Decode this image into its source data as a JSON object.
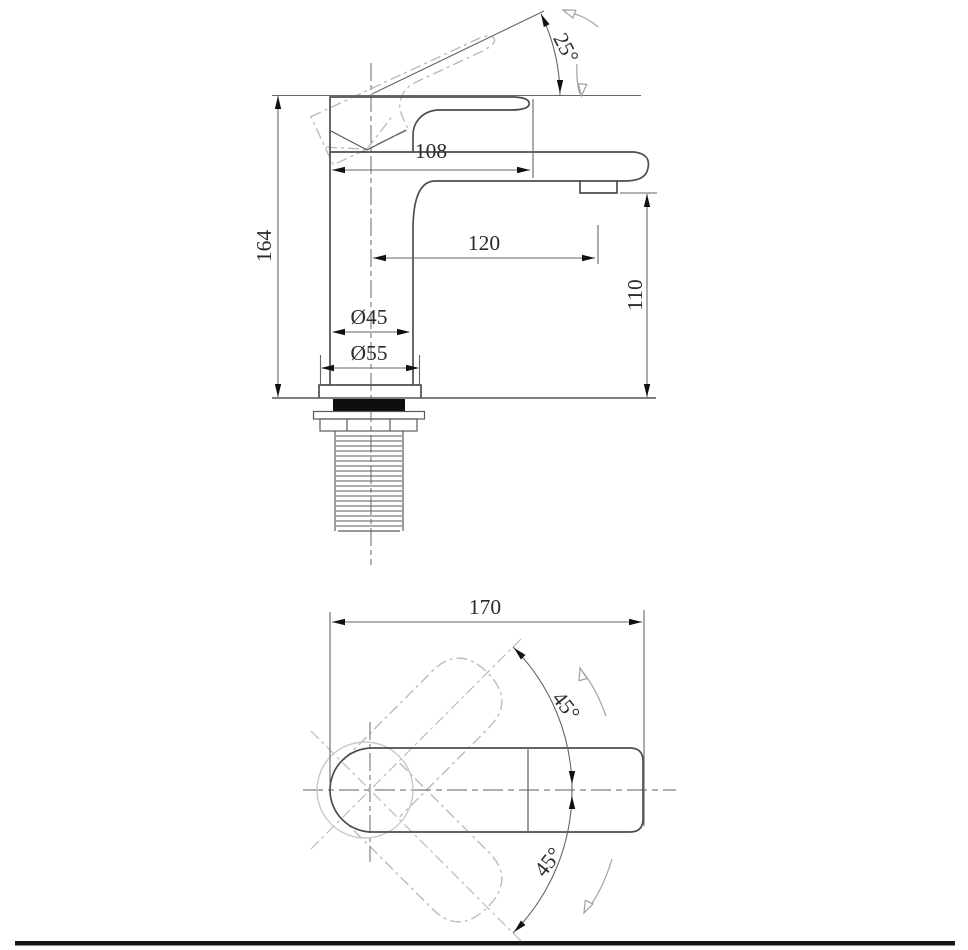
{
  "drawing": {
    "background": "#ffffff",
    "line_color": "#4d4d4d",
    "phantom_color": "#bcbcbc",
    "text_color": "#2b2b2b",
    "side_view": {
      "height": "164",
      "handle_length": "108",
      "spout_reach": "120",
      "spout_height": "110",
      "body_diameter": "Ø45",
      "base_diameter": "Ø55",
      "handle_lift_angle": "25°"
    },
    "top_view": {
      "overall_length": "170",
      "swing_angle_up": "45°",
      "swing_angle_down": "45°"
    }
  }
}
